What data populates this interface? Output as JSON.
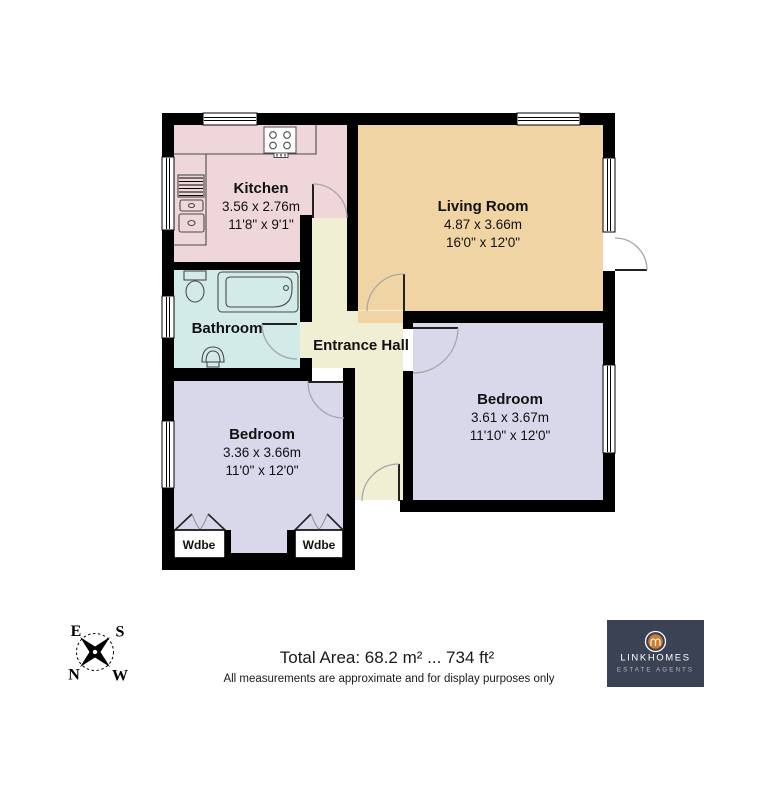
{
  "floorplan": {
    "wall_color": "#000000",
    "rooms": {
      "kitchen": {
        "label": "Kitchen",
        "metric": "3.56 x 2.76m",
        "imperial": "11'8\" x 9'1\"",
        "fill": "#eed6d9"
      },
      "living_room": {
        "label": "Living Room",
        "metric": "4.87 x 3.66m",
        "imperial": "16'0\" x 12'0\"",
        "fill": "#f1d4a4"
      },
      "bathroom": {
        "label": "Bathroom",
        "fill": "#d3ebe8"
      },
      "entrance_hall": {
        "label": "Entrance Hall",
        "fill": "#f0efd3"
      },
      "bedroom_left": {
        "label": "Bedroom",
        "metric": "3.36 x 3.66m",
        "imperial": "11'0\" x 12'0\"",
        "fill": "#d9d7ea"
      },
      "bedroom_right": {
        "label": "Bedroom",
        "metric": "3.61 x 3.67m",
        "imperial": "11'10\" x 12'0\"",
        "fill": "#d9d7ea"
      },
      "wardrobe_left": {
        "label": "Wdbe"
      },
      "wardrobe_right": {
        "label": "Wdbe"
      }
    }
  },
  "compass": {
    "n": "N",
    "s": "S",
    "e": "E",
    "w": "W"
  },
  "footer": {
    "total_area": "Total Area: 68.2 m² ... 734 ft²",
    "disclaimer": "All measurements are approximate and for display purposes only"
  },
  "logo": {
    "brand": "LINKHOMES",
    "tagline": "ESTATE AGENTS",
    "bg_color": "#3b4254",
    "accent_color": "#cc7e2d"
  }
}
